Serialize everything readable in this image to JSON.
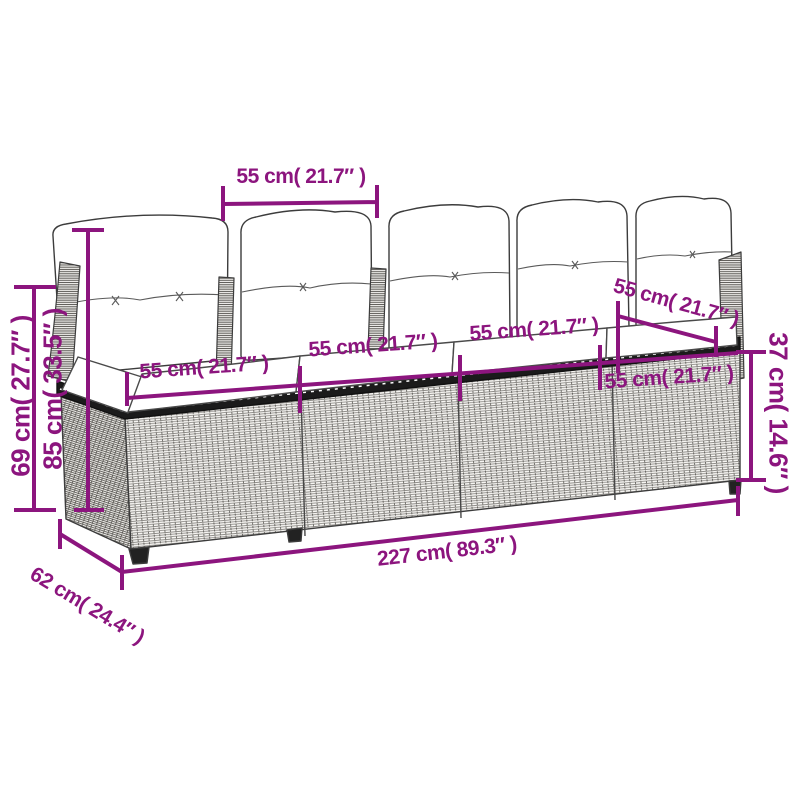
{
  "illustration": {
    "name": "rattan-sofa-line-drawing",
    "subject_icon": "wicker-garden-sofa-icon"
  },
  "colors": {
    "dimension_accent": "#8C157E",
    "line_art": "#3c3c3c"
  },
  "dimensions": {
    "pillow_width_top": "55 cm( 21.7″ )",
    "seat_depth": "55 cm( 21.7″ )",
    "seat_width_1": "55 cm( 21.7″ )",
    "seat_width_2": "55 cm( 21.7″ )",
    "seat_width_3": "55 cm( 21.7″ )",
    "seat_width_4": "55 cm( 21.7″ )",
    "height_left_outer": "69 cm( 27.7″ )",
    "height_left_inner": "85 cm( 33.5″ )",
    "seat_height_right": "37 cm( 14.6″ )",
    "total_length": "227 cm( 89.3″ )",
    "depth_bottom": "62 cm( 24.4″ )"
  }
}
